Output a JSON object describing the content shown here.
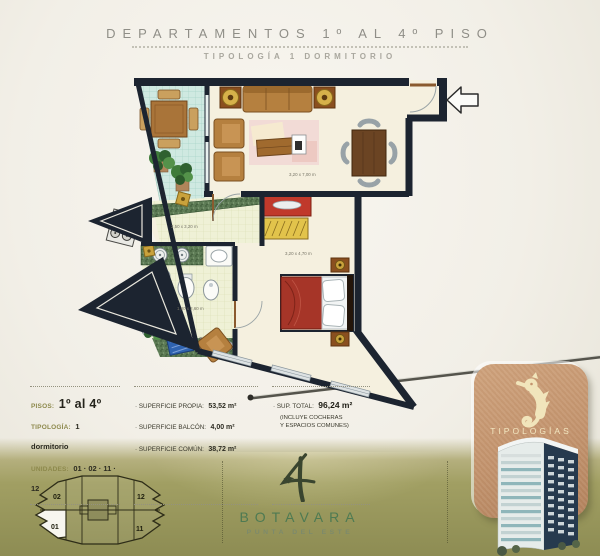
{
  "header": {
    "title": "DEPARTAMENTOS 1º AL 4º PISO",
    "subtitle": "TIPOLOGÍA 1 DORMITORIO"
  },
  "plan": {
    "living_dim": "3,20 x 7,00 m",
    "kitchen_dim": "2,50 x 3,20 m",
    "bath_dim": "1,80 x 2,60 m",
    "bedroom_dim": "3,20 x 4,70 m"
  },
  "info": {
    "pisos_label": "PISOS:",
    "pisos_value": "1º al 4º",
    "tipologia_label": "TIPOLOGÍA:",
    "tipologia_value": "1 dormitorio",
    "unidades_label": "UNIDADES:",
    "unidades_value": "01 · 02 · 11 · 12",
    "superficies": [
      {
        "label": "· SUPERFICIE PROPIA:",
        "value": "53,52 m²"
      },
      {
        "label": "· SUPERFICIE BALCÓN:",
        "value": "4,00 m²"
      },
      {
        "label": "· SUPERFICIE COMÚN:",
        "value": "38,72 m²"
      }
    ],
    "total_label": "· SUP. TOTAL:",
    "total_value": "96,24 m²",
    "total_note_line1": "(INCLUYE COCHERAS",
    "total_note_line2": "Y ESPACIOS COMUNES)"
  },
  "footer": {
    "brand": "BOTAVARA",
    "brand_sub": "PUNTA DEL ESTE",
    "miniplan": {
      "units": [
        "02",
        "12",
        "01",
        "11"
      ]
    },
    "card_label": "TIPOLOGÍAS"
  },
  "icons": {
    "entrance_arrow": "arrow-left-icon",
    "seahorse": "seahorse-icon",
    "logo_mark": "botavara-brush-4-icon"
  },
  "colors": {
    "band_olive": "#9b9960",
    "wall_navy": "#1c2430",
    "brand_green": "#4e7a52",
    "card_terracotta": "#c49a76",
    "bed_red": "#a63528",
    "balcony_teal": "#cfe9e1",
    "accent_gold": "#8d894c"
  }
}
